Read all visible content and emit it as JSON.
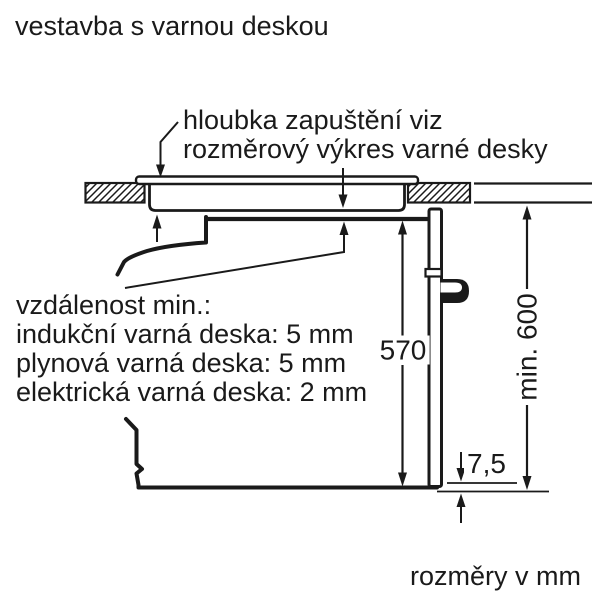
{
  "colors": {
    "ink": "#1a1a1a",
    "background": "#ffffff"
  },
  "title": "vestavba s varnou deskou",
  "recess_note": {
    "line1": "hloubka zapuštění viz",
    "line2": "rozměrový výkres varné desky"
  },
  "distance_note": {
    "heading": "vzdálenost min.:",
    "items": [
      "indukční varná deska: 5 mm",
      "plynová varná deska: 5 mm",
      "elektrická varná deska: 2 mm"
    ]
  },
  "dimensions": {
    "oven_height": "570",
    "niche_height": "min. 600",
    "door_bottom_gap": "7,5"
  },
  "units_note": "rozměry v mm"
}
